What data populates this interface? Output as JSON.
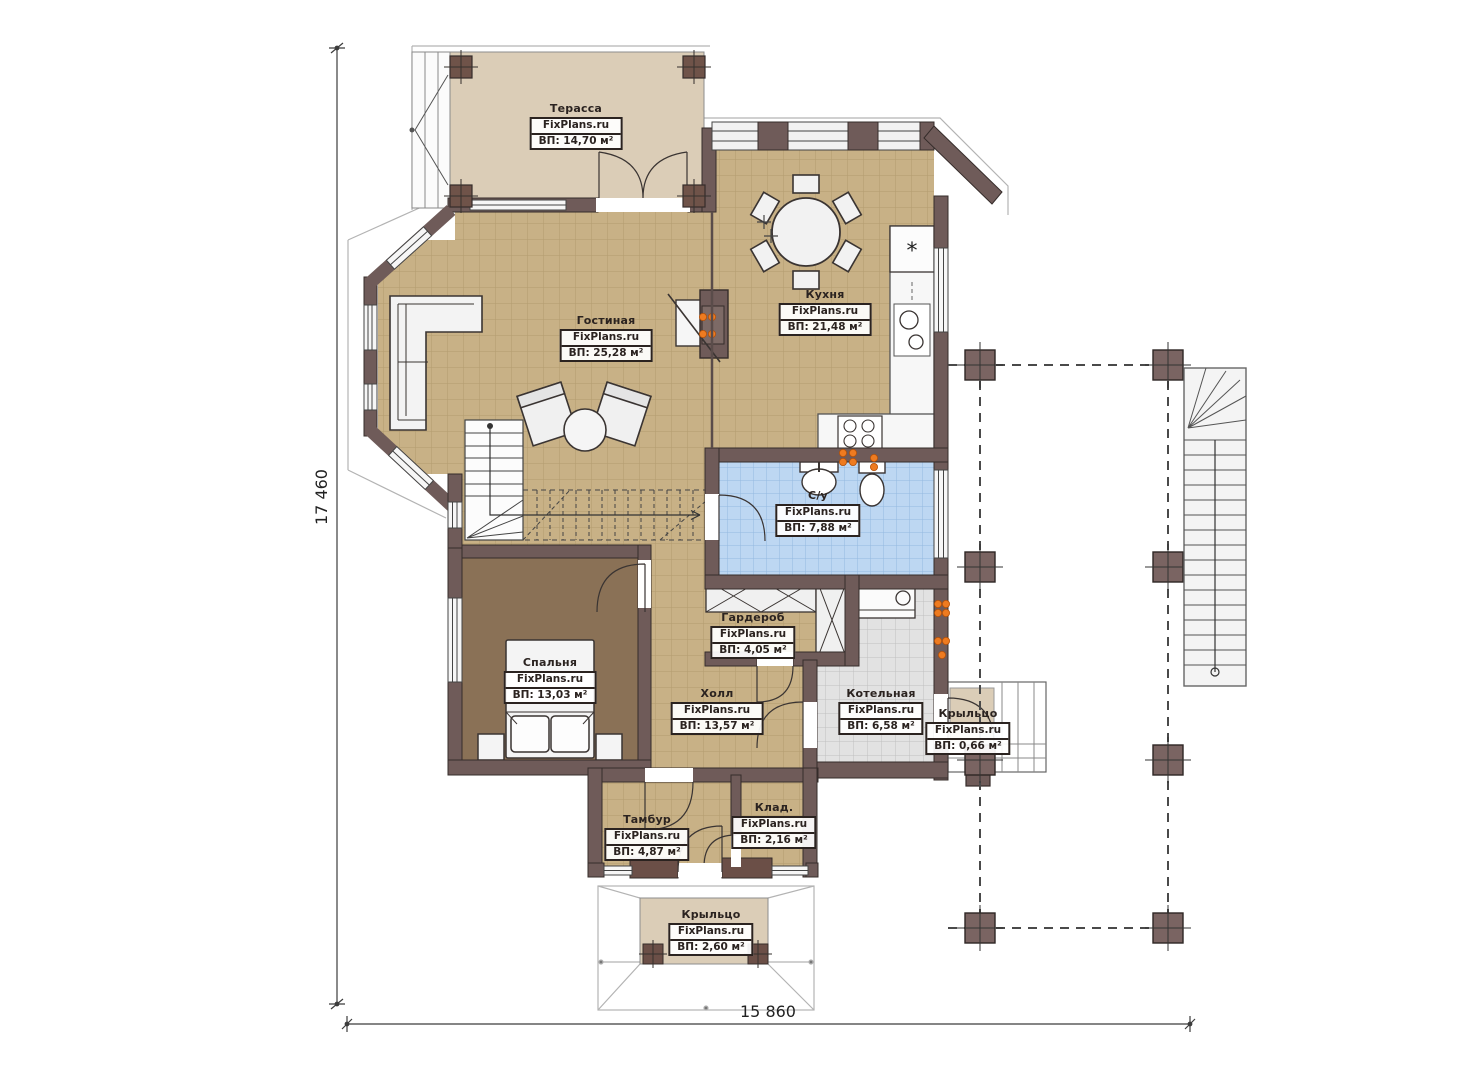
{
  "brand": "FixPlans.ru",
  "dimensions": {
    "height_mm": "17 460",
    "width_mm": "15 860"
  },
  "rooms": [
    {
      "name": "Терасса",
      "area": "ВП: 14,70 м²"
    },
    {
      "name": "Гостиная",
      "area": "ВП: 25,28 м²"
    },
    {
      "name": "Кухня",
      "area": "ВП: 21,48 м²"
    },
    {
      "name": "С/у",
      "area": "ВП: 7,88 м²"
    },
    {
      "name": "Гардероб",
      "area": "ВП: 4,05 м²"
    },
    {
      "name": "Спальня",
      "area": "ВП: 13,03 м²"
    },
    {
      "name": "Холл",
      "area": "ВП: 13,57 м²"
    },
    {
      "name": "Котельная",
      "area": "ВП: 6,58 м²"
    },
    {
      "name": "Крыльцо",
      "area": "ВП: 0,66 м²"
    },
    {
      "name": "Тамбур",
      "area": "ВП: 4,87 м²"
    },
    {
      "name": "Клад.",
      "area": "ВП: 2,16 м²"
    },
    {
      "name": "Крыльцо",
      "area": "ВП: 2,60 м²"
    }
  ],
  "colors": {
    "wall": "#6f5b59",
    "floor_tan": "#c8b186",
    "floor_blue": "#bdd7f2",
    "floor_gray": "#e2e2e2",
    "floor_bedroom": "#8a7156",
    "terrace_beige": "#dbcdb7",
    "radiator_orange": "#ee7b20"
  }
}
